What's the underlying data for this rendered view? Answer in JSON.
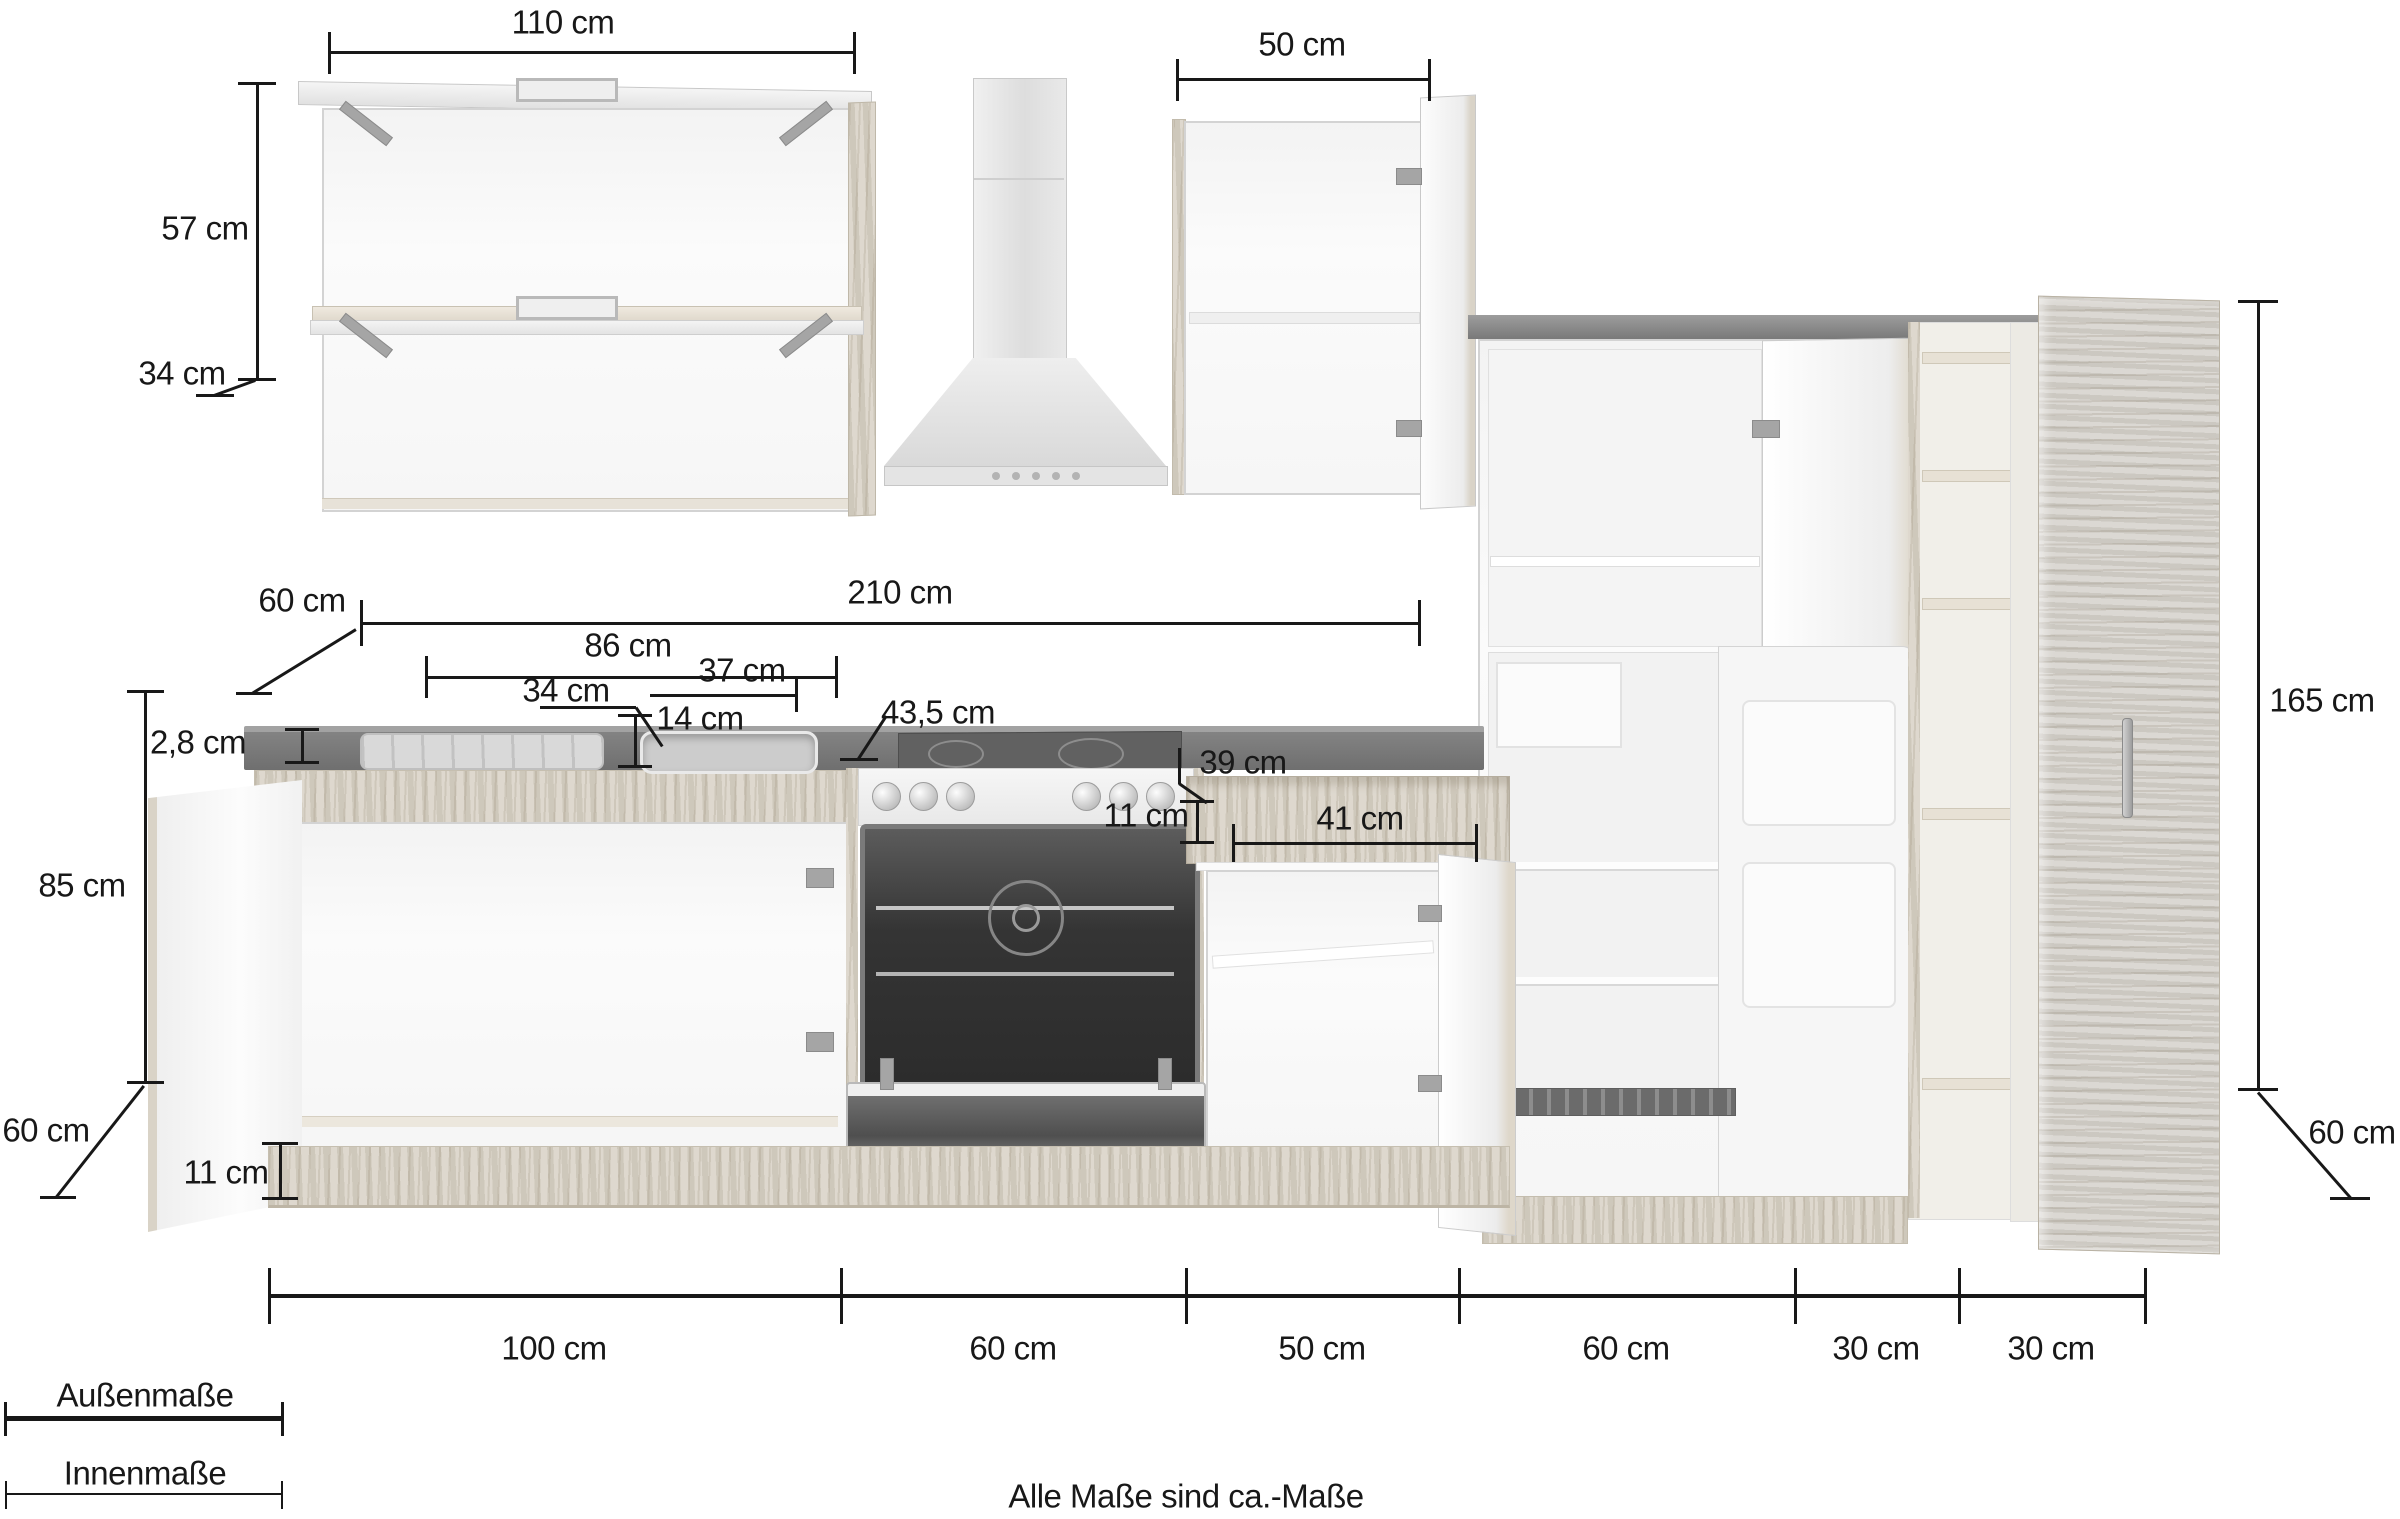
{
  "dims": {
    "wall_left_width": "110 cm",
    "wall_left_height": "57 cm",
    "wall_left_depth": "34 cm",
    "wall_right_width": "50 cm",
    "worktop_depth": "60 cm",
    "worktop_run": "210 cm",
    "sink_run": "86 cm",
    "drainer_width": "34 cm",
    "bowl_width": "37 cm",
    "bowl_depth": "14 cm",
    "hob_width": "43,5 cm",
    "worktop_thickness": "2,8 cm",
    "niche_depth": "39 cm",
    "niche_height": "11 cm",
    "drawer_width": "41 cm",
    "base_height": "85 cm",
    "base_depth": "60 cm",
    "plinth_height": "11 cm",
    "tall_height": "165 cm",
    "tall_depth": "60 cm",
    "bottom": [
      "100 cm",
      "60 cm",
      "50 cm",
      "60 cm",
      "30 cm",
      "30 cm"
    ]
  },
  "legend": {
    "outer": "Außenmaße",
    "inner": "Innenmaße"
  },
  "note": "Alle Maße sind ca.-Maße"
}
